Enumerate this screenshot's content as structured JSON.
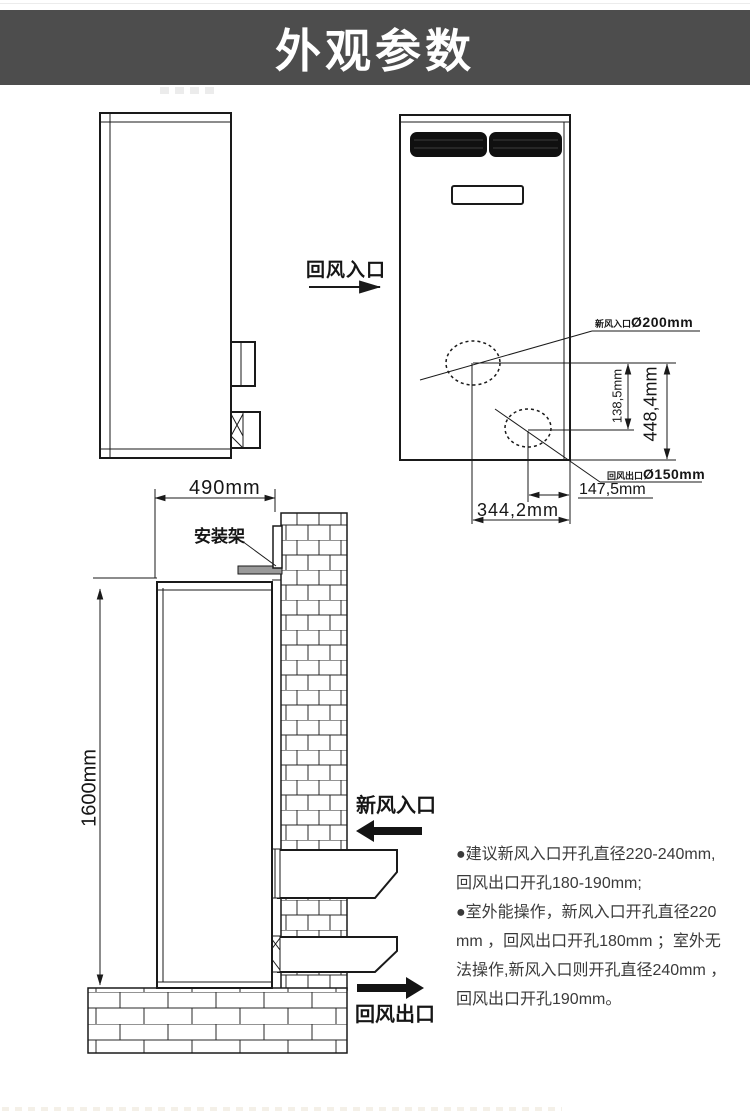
{
  "header": {
    "title": "外观参数"
  },
  "colors": {
    "banner_bg": "#4d4d4d",
    "linework": "#1a1a1a",
    "grille_fill": "#101010"
  },
  "top_section": {
    "return_air_inlet_label": "回风入口",
    "fresh_air_hole": {
      "name": "新风入口",
      "diameter": "Ø200mm"
    },
    "return_air_hole": {
      "name": "回风出口",
      "diameter": "Ø150mm"
    },
    "dim_vertical_small": "138,5mm",
    "dim_vertical_large": "448,4mm",
    "dim_horizontal_small": "147,5mm",
    "dim_horizontal_large": "344,2mm"
  },
  "install_section": {
    "dim_width": "490mm",
    "dim_height": "1600mm",
    "bracket_label": "安装架",
    "fresh_air_inlet_label": "新风入口",
    "return_air_outlet_label": "回风出口"
  },
  "notes": {
    "lines": [
      "●建议新风入口开孔直径220-240mm,",
      "回风出口开孔180-190mm;",
      "●室外能操作，新风入口开孔直径220",
      "mm ，回风出口开孔180mm ；室外无",
      "法操作,新风入口则开孔直径240mm ，",
      "回风出口开孔190mm。"
    ]
  }
}
